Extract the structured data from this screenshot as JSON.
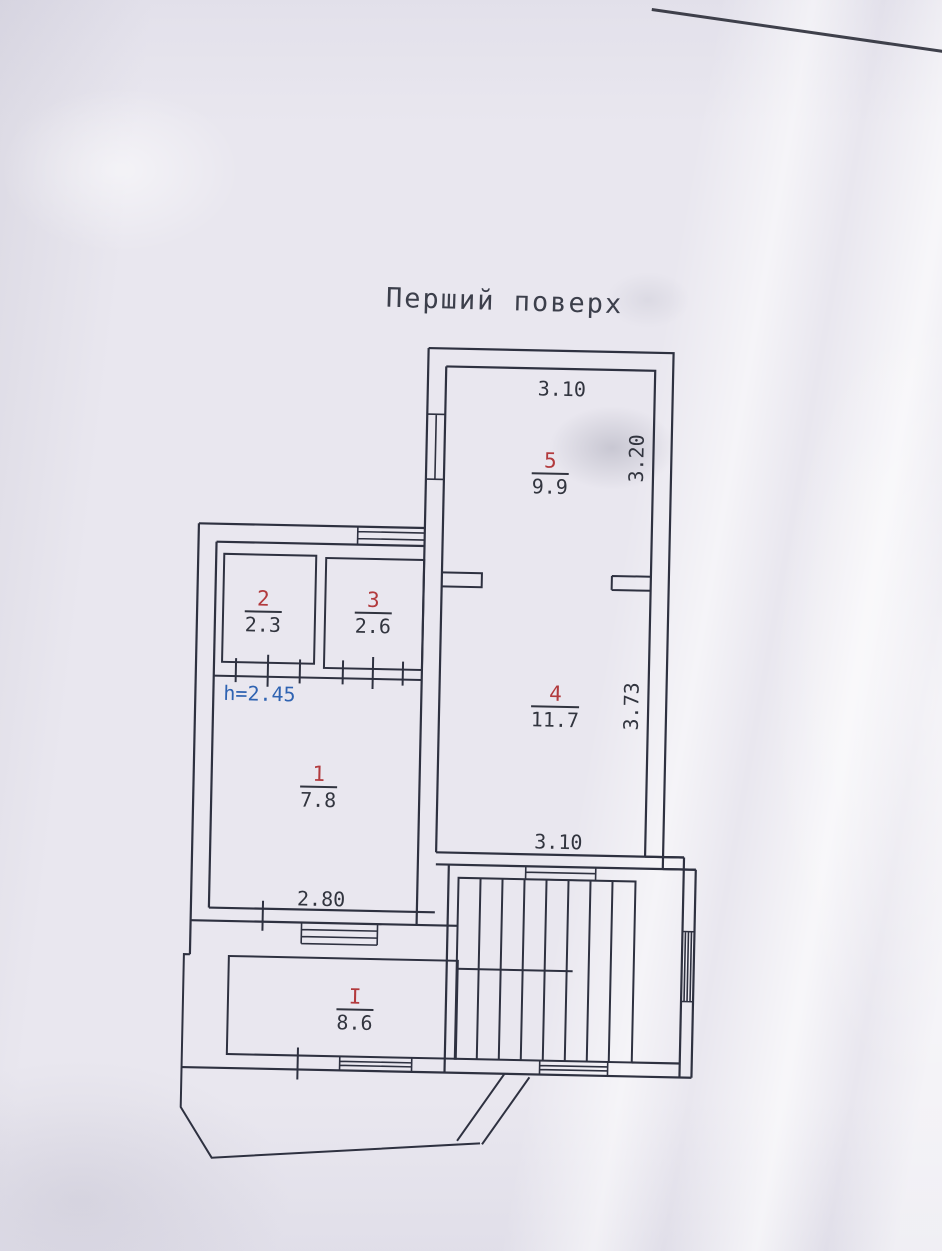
{
  "title": "Перший поверх",
  "rooms": {
    "r5": {
      "number": "5",
      "area": "9.9"
    },
    "r4": {
      "number": "4",
      "area": "11.7"
    },
    "r2": {
      "number": "2",
      "area": "2.3"
    },
    "r3": {
      "number": "3",
      "area": "2.6"
    },
    "r1": {
      "number": "1",
      "area": "7.8"
    },
    "rI": {
      "number": "I",
      "area": "8.6"
    }
  },
  "dimensions": {
    "room5_width_top": "3.10",
    "room5_depth_right": "3.20",
    "room4_depth_right": "3.73",
    "room4_width_bottom": "3.10",
    "room1_width_bottom": "2.80"
  },
  "height_note": "h=2.45",
  "colors": {
    "ink": "#31343f",
    "room_number_red": "#b23a3d",
    "height_note_blue": "#2f63b2",
    "paper": "#e9e7ef"
  }
}
